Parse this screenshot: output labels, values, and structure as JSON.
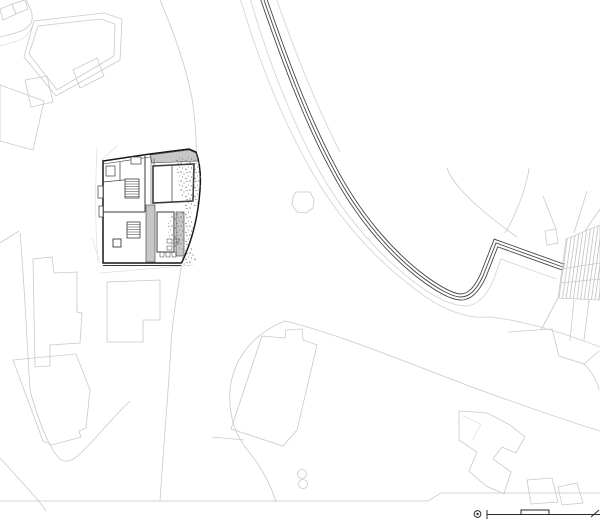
{
  "page": {
    "title": "Architectural site plan",
    "viewbox": "0 0 600 522",
    "canvas": {
      "width": 600,
      "height": 522
    }
  },
  "colors": {
    "paper": "#ffffff",
    "faint": "#c9c9c9",
    "xlight": "#dedede",
    "roadlight": "#d6d6d6",
    "roaddark": "#454545",
    "outline": "#161616",
    "wall": "#3a3a3a",
    "fillgray": "#c6c8c6",
    "stipple": "#7a7a7a",
    "hatchline": "#b8b8b8",
    "scale": "#2a2a2a"
  },
  "drawing": {
    "type": "site plan line drawing",
    "elements": {
      "main_building": "detailed floor plan with interior walls, two stairs, grey terrace strips and vegetation stipple",
      "road": "curving route drawn as three dark parallel lines, bending from top edge to right edge",
      "stairway": "hatched exterior stair ramp at the right edge",
      "parcels": "light grey outlines of neighbouring buildings and lot boundaries",
      "tree_circle": "small octagonal tree outline near centre",
      "twin_circles": "small figure-eight pair of circles at bottom centre",
      "scale_bar": "graphic scale bar with circled point symbol at bottom right"
    }
  }
}
